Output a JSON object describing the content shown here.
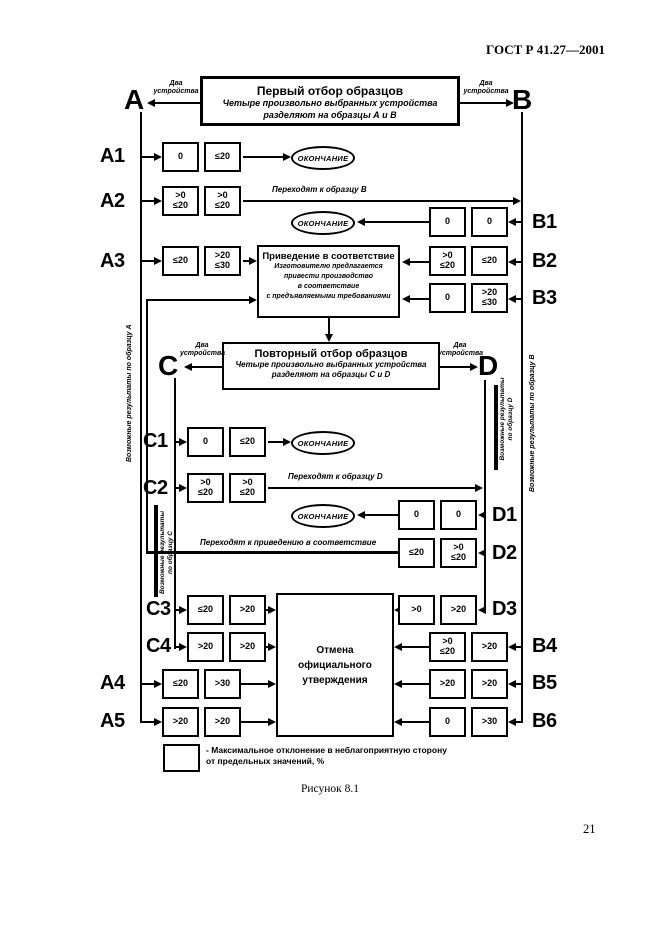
{
  "header": {
    "standard": "ГОСТ Р 41.27—2001",
    "page_number": "21"
  },
  "colors": {
    "ink": "#000000",
    "paper": "#ffffff"
  },
  "first_selection": {
    "title": "Первый отбор образцов",
    "sub1": "Четыре произвольно выбранных устройства",
    "sub2": "разделяют на образцы А и В"
  },
  "alignment": {
    "title": "Приведение в соответствие",
    "sub1": "Изготовителю предлагается",
    "sub2": "привести производство",
    "sub3": "в соответствие",
    "sub4": "с предъявляемыми требованиями"
  },
  "resampling": {
    "title": "Повторный отбор образцов",
    "sub1": "Четыре произвольно выбранных устройства",
    "sub2": "разделяют на образцы C и D"
  },
  "revocation": {
    "line1": "Отмена",
    "line2": "официального",
    "line3": "утверждения"
  },
  "terminator": "ОКОНЧАНИЕ",
  "device_note": {
    "line1": "Два",
    "line2": "устройства"
  },
  "branches": {
    "a": "А",
    "b": "В",
    "c": "C",
    "d": "D"
  },
  "flow_labels": {
    "to_sample_b": "Переходят к образцу В",
    "to_sample_d": "Переходят к образцу D",
    "to_alignment": "Переходят к приведению в соответствие"
  },
  "side_labels": {
    "a": "Возможные результаты по образцу А",
    "b": "Возможные результаты по образцу В",
    "c1": "Возможные результаты",
    "c2": "по образцу С",
    "d1": "Возможные результаты",
    "d2": "по образцу D"
  },
  "rows": {
    "a1": {
      "label": "А1",
      "v1": "0",
      "v2": "≤20"
    },
    "a2": {
      "label": "А2",
      "v1": ">0\n≤20",
      "v2": ">0\n≤20"
    },
    "a3": {
      "label": "А3",
      "v1": "≤20",
      "v2": ">20\n≤30"
    },
    "b1": {
      "label": "В1",
      "v1": "0",
      "v2": "0"
    },
    "b2": {
      "label": "В2",
      "v1": ">0\n≤20",
      "v2": "≤20"
    },
    "b3": {
      "label": "В3",
      "v1": "0",
      "v2": ">20\n≤30"
    },
    "c1": {
      "label": "C1",
      "v1": "0",
      "v2": "≤20"
    },
    "c2": {
      "label": "C2",
      "v1": ">0\n≤20",
      "v2": ">0\n≤20"
    },
    "d1": {
      "label": "D1",
      "v1": "0",
      "v2": "0"
    },
    "d2": {
      "label": "D2",
      "v1": "≤20",
      "v2": ">0\n≤20"
    },
    "c3": {
      "label": "C3",
      "v1": "≤20",
      "v2": ">20"
    },
    "c4": {
      "label": "C4",
      "v1": ">20",
      "v2": ">20"
    },
    "a4": {
      "label": "А4",
      "v1": "≤20",
      "v2": ">30"
    },
    "a5": {
      "label": "А5",
      "v1": ">20",
      "v2": ">20"
    },
    "d3": {
      "label": "D3",
      "v1": ">0",
      "v2": ">20"
    },
    "b4": {
      "label": "В4",
      "v1": ">0\n≤20",
      "v2": ">20"
    },
    "b5": {
      "label": "В5",
      "v1": ">20",
      "v2": ">20"
    },
    "b6": {
      "label": "В6",
      "v1": "0",
      "v2": ">30"
    }
  },
  "legend": {
    "line1": "- Максимальное отклонение в неблагоприятную сторону",
    "line2": "от предельных значений, %"
  },
  "caption": "Рисунок 8.1"
}
